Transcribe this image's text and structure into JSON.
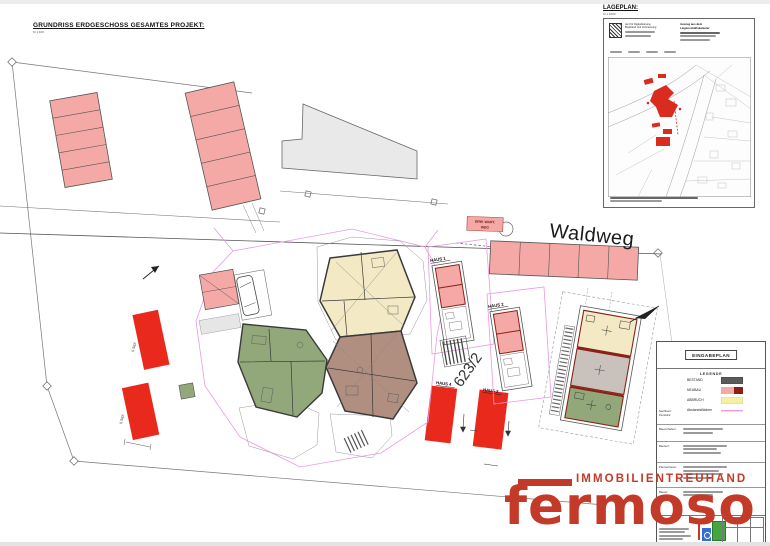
{
  "titles": {
    "main": "GRUNDRISS ERDGESCHOSS GESAMTES PROJEKT:",
    "main_scale": "M 1:100"
  },
  "lageplan": {
    "title": "LAGEPLAN:",
    "scale": "M 1:1000",
    "office": [
      "Amt für Digitalisierung,",
      "Breitband und Vermessung"
    ],
    "excerpt": [
      "Auszug aus dem",
      "Liegenschaftskataster"
    ]
  },
  "site": {
    "street_label": "Waldweg",
    "parcel_number": "623/2",
    "house_labels": {
      "h1": "HAUS 1",
      "h2": "HAUS 2",
      "h3": "HAUS 3",
      "h4": "HAUS 4"
    },
    "parking_label_upper": "5 Stpl.",
    "parking_label_lower": "5 Stpl.",
    "shelter_label": [
      "ERW. WART.",
      "WEG"
    ]
  },
  "legend": {
    "plan_type": "EINGABEPLAN",
    "heading": "LEGENDE",
    "items": [
      {
        "label": "BESTAND",
        "color": "#5a5a5a"
      },
      {
        "label": "NEUBAU",
        "color": "#f4a9a6",
        "color2": "#8a1f16"
      },
      {
        "label": "ABBRUCH",
        "color": "#f6f0a0"
      },
      {
        "label": "Abstandsflächen",
        "color": "#ea9ae0"
      }
    ],
    "side_note": [
      "Nachbarn:",
      "Flurstück"
    ]
  },
  "titleblock": {
    "rows": [
      {
        "label": "Bauvorhaben:"
      },
      {
        "label": "Bauherr:"
      },
      {
        "label": "Planverfasser:"
      },
      {
        "label": "Bauort:"
      }
    ]
  },
  "watermark": {
    "tagline": "IMMOBILIENTREUHAND",
    "brand": "fermoso"
  },
  "colors": {
    "parking_pink": "#f4a9a6",
    "highlight_red": "#e8291c",
    "unit_cream": "#f3e9c4",
    "unit_brown": "#b18f80",
    "unit_green": "#93a87a",
    "unit_gray": "#c9c2bc",
    "existing_gray": "#e9e9e9",
    "wall_dark": "#3a3a3a",
    "wall_red": "#8a2018",
    "setback_magenta": "#ea9ae0",
    "logo_red": "#c43a28",
    "legend_yellow": "#f6f0a0",
    "legend_dark": "#5a5a5a",
    "map_red": "#d92b1e"
  }
}
